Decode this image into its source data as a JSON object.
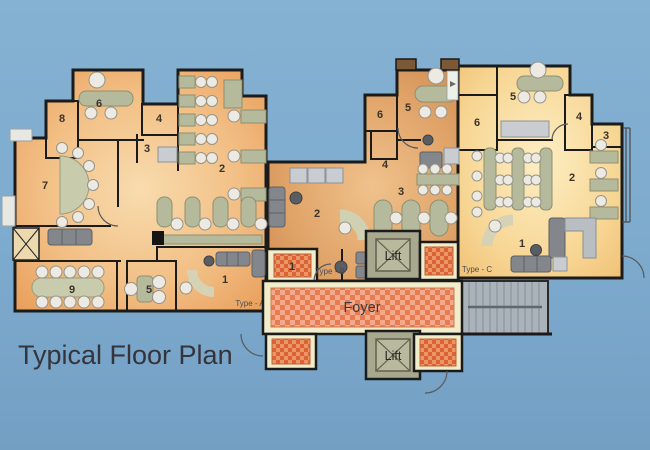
{
  "title": "Typical Floor Plan",
  "units": {
    "type_a": {
      "label": "Type - A",
      "rooms": {
        "r1": "1",
        "r2": "2",
        "r3": "3",
        "r4": "4",
        "r5": "5",
        "r6": "6",
        "r7": "7",
        "r8": "8",
        "r9": "9"
      }
    },
    "type_b": {
      "label": "Type - B",
      "rooms": {
        "r1": "1",
        "r2": "2",
        "r3": "3",
        "r4": "4",
        "r5": "5",
        "r6": "6"
      }
    },
    "type_c": {
      "label": "Type - C",
      "rooms": {
        "r1": "1",
        "r2": "2",
        "r3": "3",
        "r4": "4",
        "r5": "5",
        "r6": "6"
      }
    }
  },
  "core": {
    "foyer": "Foyer",
    "lift_upper": "Lift",
    "lift_lower": "Lift"
  },
  "colors": {
    "background": "#7dabce",
    "walls": "#1b1b1b",
    "floor_type_a": "#eca566",
    "floor_type_b": "#d28d55",
    "floor_type_c": "#f0bf74",
    "toilet_checker": "#db6434",
    "foyer_checker": "#e87f55",
    "foyer_border": "#f1ecca",
    "lift": "#a8a88e",
    "stairs": "#aab2ba"
  }
}
